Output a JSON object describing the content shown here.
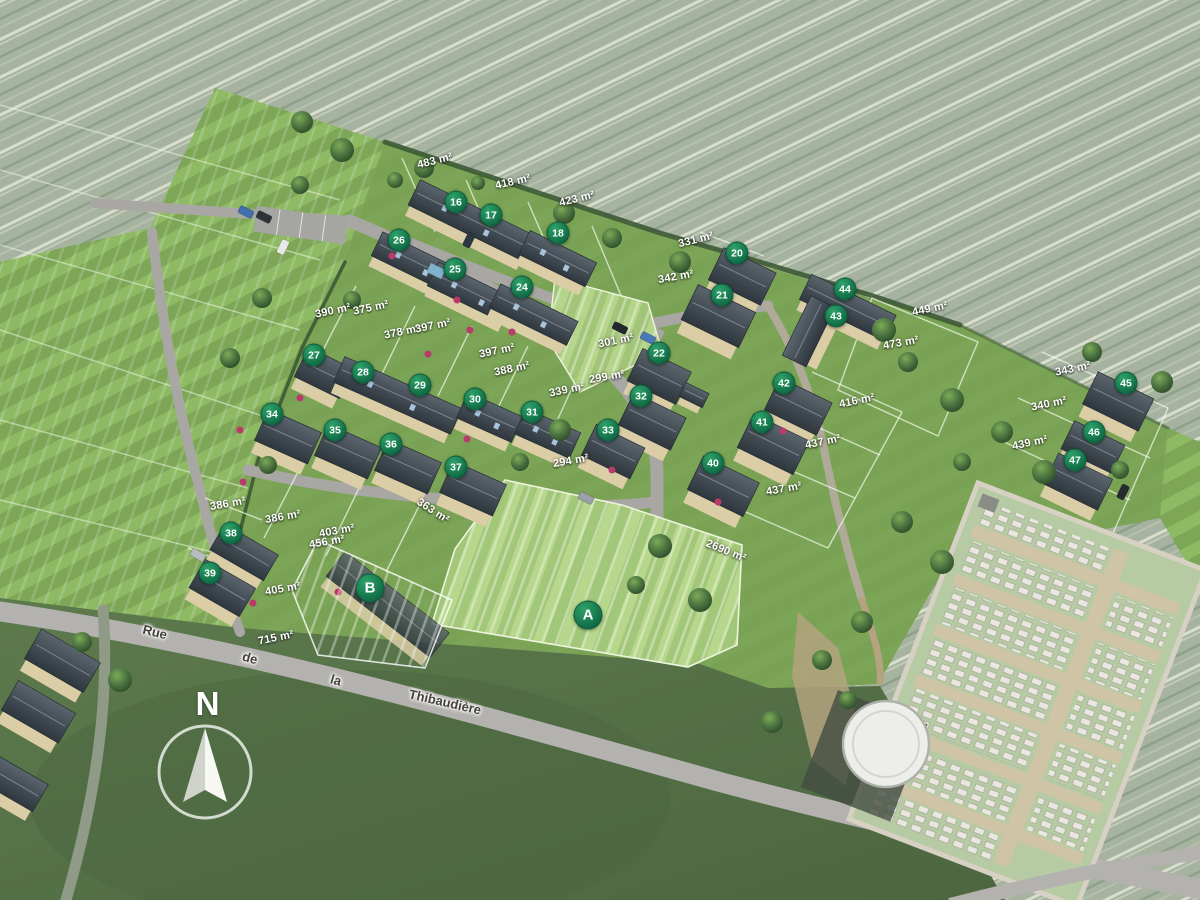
{
  "compass": {
    "label": "N"
  },
  "street": {
    "name": "Rue de la Thibaudière",
    "words": [
      {
        "text": "Rue",
        "x": 155,
        "y": 632,
        "rot": 14
      },
      {
        "text": "de",
        "x": 250,
        "y": 658,
        "rot": 16
      },
      {
        "text": "la",
        "x": 336,
        "y": 680,
        "rot": 16
      },
      {
        "text": "Thibaudière",
        "x": 445,
        "y": 702,
        "rot": 13
      }
    ]
  },
  "zones": [
    {
      "label": "A",
      "x": 588,
      "y": 615
    },
    {
      "label": "B",
      "x": 370,
      "y": 588
    }
  ],
  "lots": [
    {
      "num": "16",
      "x": 456,
      "y": 202
    },
    {
      "num": "17",
      "x": 491,
      "y": 215
    },
    {
      "num": "18",
      "x": 558,
      "y": 233
    },
    {
      "num": "26",
      "x": 399,
      "y": 240
    },
    {
      "num": "25",
      "x": 455,
      "y": 269
    },
    {
      "num": "24",
      "x": 522,
      "y": 287
    },
    {
      "num": "20",
      "x": 737,
      "y": 253
    },
    {
      "num": "21",
      "x": 722,
      "y": 295
    },
    {
      "num": "44",
      "x": 845,
      "y": 289
    },
    {
      "num": "43",
      "x": 836,
      "y": 316
    },
    {
      "num": "27",
      "x": 314,
      "y": 355
    },
    {
      "num": "28",
      "x": 363,
      "y": 372
    },
    {
      "num": "29",
      "x": 420,
      "y": 385
    },
    {
      "num": "30",
      "x": 475,
      "y": 399
    },
    {
      "num": "31",
      "x": 532,
      "y": 412
    },
    {
      "num": "22",
      "x": 659,
      "y": 353
    },
    {
      "num": "32",
      "x": 641,
      "y": 396
    },
    {
      "num": "42",
      "x": 784,
      "y": 383
    },
    {
      "num": "41",
      "x": 762,
      "y": 422
    },
    {
      "num": "40",
      "x": 713,
      "y": 463
    },
    {
      "num": "45",
      "x": 1126,
      "y": 383
    },
    {
      "num": "46",
      "x": 1094,
      "y": 432
    },
    {
      "num": "47",
      "x": 1075,
      "y": 460
    },
    {
      "num": "34",
      "x": 272,
      "y": 414
    },
    {
      "num": "35",
      "x": 335,
      "y": 430
    },
    {
      "num": "36",
      "x": 391,
      "y": 444
    },
    {
      "num": "37",
      "x": 456,
      "y": 467
    },
    {
      "num": "33",
      "x": 608,
      "y": 430
    },
    {
      "num": "38",
      "x": 231,
      "y": 533
    },
    {
      "num": "39",
      "x": 210,
      "y": 573
    }
  ],
  "areas": [
    {
      "text": "483 m²",
      "x": 435,
      "y": 161,
      "rot": -14
    },
    {
      "text": "418 m²",
      "x": 513,
      "y": 182,
      "rot": -13
    },
    {
      "text": "423 m²",
      "x": 577,
      "y": 199,
      "rot": -14
    },
    {
      "text": "331 m²",
      "x": 696,
      "y": 240,
      "rot": -14
    },
    {
      "text": "342 m²",
      "x": 676,
      "y": 277,
      "rot": -10
    },
    {
      "text": "390 m²",
      "x": 333,
      "y": 311,
      "rot": -12
    },
    {
      "text": "375 m²",
      "x": 371,
      "y": 308,
      "rot": -12
    },
    {
      "text": "378 m²",
      "x": 402,
      "y": 332,
      "rot": -12
    },
    {
      "text": "397 m²",
      "x": 433,
      "y": 326,
      "rot": -12
    },
    {
      "text": "397 m²",
      "x": 497,
      "y": 351,
      "rot": -12
    },
    {
      "text": "388 m²",
      "x": 512,
      "y": 369,
      "rot": -12
    },
    {
      "text": "301 m²",
      "x": 616,
      "y": 341,
      "rot": -12
    },
    {
      "text": "299 m²",
      "x": 607,
      "y": 377,
      "rot": -10
    },
    {
      "text": "339 m²",
      "x": 567,
      "y": 390,
      "rot": -12
    },
    {
      "text": "294 m²",
      "x": 571,
      "y": 461,
      "rot": -10
    },
    {
      "text": "449 m²",
      "x": 930,
      "y": 309,
      "rot": -12
    },
    {
      "text": "473 m²",
      "x": 901,
      "y": 343,
      "rot": -10
    },
    {
      "text": "416 m²",
      "x": 857,
      "y": 401,
      "rot": -12
    },
    {
      "text": "437 m²",
      "x": 823,
      "y": 442,
      "rot": -12
    },
    {
      "text": "437 m²",
      "x": 784,
      "y": 489,
      "rot": -10
    },
    {
      "text": "343 m²",
      "x": 1073,
      "y": 369,
      "rot": -12
    },
    {
      "text": "340 m²",
      "x": 1049,
      "y": 404,
      "rot": -12
    },
    {
      "text": "439 m²",
      "x": 1030,
      "y": 443,
      "rot": -12
    },
    {
      "text": "386 m²",
      "x": 228,
      "y": 504,
      "rot": -10
    },
    {
      "text": "386 m²",
      "x": 283,
      "y": 517,
      "rot": -10
    },
    {
      "text": "403 m²",
      "x": 337,
      "y": 531,
      "rot": -10
    },
    {
      "text": "456 m²",
      "x": 327,
      "y": 542,
      "rot": -10
    },
    {
      "text": "363 m²",
      "x": 433,
      "y": 511,
      "rot": 33
    },
    {
      "text": "405 m²",
      "x": 283,
      "y": 589,
      "rot": -10
    },
    {
      "text": "715 m²",
      "x": 276,
      "y": 638,
      "rot": -12
    },
    {
      "text": "2690 m²",
      "x": 726,
      "y": 551,
      "rot": 22
    }
  ],
  "colors": {
    "marker_green": "#127049",
    "label_text": "#ffffff",
    "street_text": "#45423c"
  }
}
